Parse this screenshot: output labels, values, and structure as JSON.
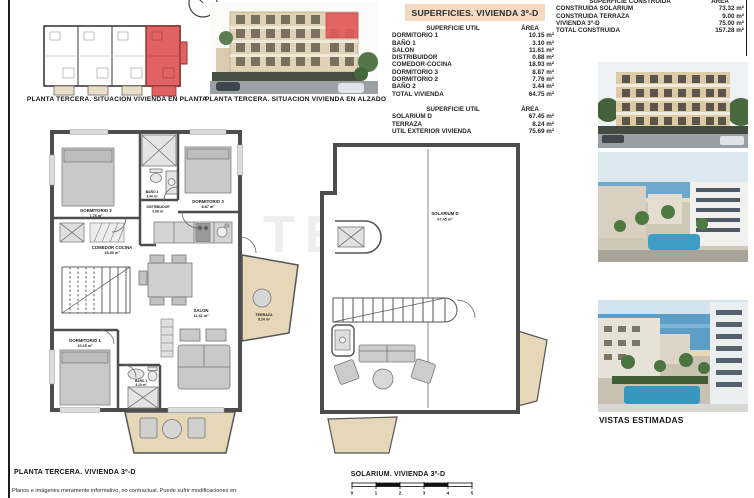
{
  "colors": {
    "highlight_red": "#e06262",
    "terrace_beige": "#e6d7b8",
    "title_bar_peach": "#f3d9c2",
    "wall_gray": "#4d4d4d"
  },
  "watermark": "TEKCE",
  "disclaimer": "Planos e imágenes meramente informativo, no contractual. Puede sufrir modificaciones en",
  "situation_plan": {
    "caption": "PLANTA TERCERA. SITUACION VIVIENDA EN PLANTA"
  },
  "elevation": {
    "caption": "PLANTA TERCERA. SITUACION VIVIENDA EN ALZADO"
  },
  "surfaces": {
    "title": "SUPERFICIES. VIVIENDA 3º-D",
    "util_vivienda": {
      "col_label": "SUPERFICIE UTIL",
      "col_area": "ÁREA",
      "rows": [
        {
          "label": "DORMITORIO 1",
          "area": "10.15 m²"
        },
        {
          "label": "BAÑO 1",
          "area": "3.10 m²"
        },
        {
          "label": "SALON",
          "area": "11.61 m²"
        },
        {
          "label": "DISTRIBUIDOR",
          "area": "0.88 m²"
        },
        {
          "label": "COMEDOR-COCINA",
          "area": "18.93 m²"
        },
        {
          "label": "DORMITORIO 3",
          "area": "8.87 m²"
        },
        {
          "label": "DORMITORIO 2",
          "area": "7.76 m²"
        },
        {
          "label": "BAÑO 2",
          "area": "3.44 m²"
        },
        {
          "label": "TOTAL VIVIENDA",
          "area": "64.75 m²"
        }
      ]
    },
    "util_exterior": {
      "col_label": "SUPERFICIE UTIL",
      "col_area": "ÁREA",
      "rows": [
        {
          "label": "SOLARIUM D",
          "area": "67.45 m²"
        },
        {
          "label": "TERRAZA",
          "area": "8.24 m²"
        },
        {
          "label": "UTIL EXTERIOR VIVIENDA",
          "area": "75.69 m²"
        }
      ]
    },
    "construida": {
      "col_label": "SUPERFICIE CONSTRUIDA",
      "col_area": "ÁREA",
      "rows": [
        {
          "label": "CONSTRUIDA SOLARIUM",
          "area": "73.32 m²"
        },
        {
          "label": "CONSTRUIDA TERRAZA",
          "area": "9.00 m²"
        },
        {
          "label": "VIVIENDA 3º-D",
          "area": "75.00 m²"
        },
        {
          "label": "TOTAL CONSTRUIDA",
          "area": "157.28 m²"
        }
      ]
    }
  },
  "main_plan": {
    "caption": "PLANTA TERCERA. VIVIENDA 3º-D",
    "rooms": [
      {
        "name": "DORMITORIO 2",
        "area": "7.76 m²"
      },
      {
        "name": "BAÑO 2",
        "area": "3.44 m²"
      },
      {
        "name": "DORMITORIO 3",
        "area": "8.87 m²"
      },
      {
        "name": "DISTRIBUIDOR",
        "area": "0.88 m²"
      },
      {
        "name": "COMEDOR COCINA",
        "area": "18.93 m²"
      },
      {
        "name": "DORMITORIO 1",
        "area": "10.15 m²"
      },
      {
        "name": "BAÑO 1",
        "area": "3.10 m²"
      },
      {
        "name": "SALON",
        "area": "11.61 m²"
      },
      {
        "name": "TERRAZA",
        "area": "8.24 m²"
      }
    ]
  },
  "solarium_plan": {
    "caption": "SOLARIUM. VIVIENDA 3º-D",
    "room": {
      "name": "SOLARIUM D",
      "area": "67.45 m²"
    },
    "scale_ticks": [
      "0",
      "1",
      "2",
      "3",
      "4",
      "5"
    ]
  },
  "views": {
    "caption": "VISTAS ESTIMADAS"
  }
}
